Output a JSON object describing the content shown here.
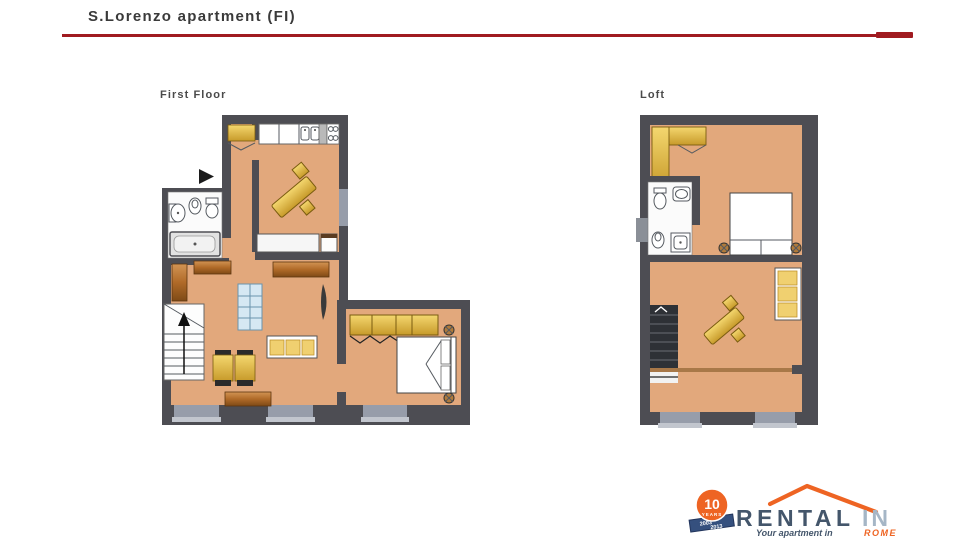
{
  "page": {
    "title": "S.Lorenzo apartment (FI)"
  },
  "divider": {
    "color": "#a01b20"
  },
  "plans": {
    "first_floor": {
      "label": "First Floor"
    },
    "loft": {
      "label": "Loft"
    }
  },
  "colors": {
    "wall": "#4d4d53",
    "floor": "#e2a87c",
    "furniture_gold": "#e0b344",
    "furniture_brown": "#b06a28",
    "window_gray": "#979daa",
    "glass_blue": "#d6e8f3",
    "accent_red": "#a01b20"
  },
  "logo": {
    "badge_number": "10",
    "badge_label": "YEARS",
    "badge_year_top": "2003",
    "badge_year_bottom": "2013",
    "brand_main": "RENTAL",
    "brand_accent": "IN",
    "tagline": "Your apartment in",
    "tagline_city": "ROME",
    "orange": "#ee6423",
    "navy": "#44566b"
  }
}
